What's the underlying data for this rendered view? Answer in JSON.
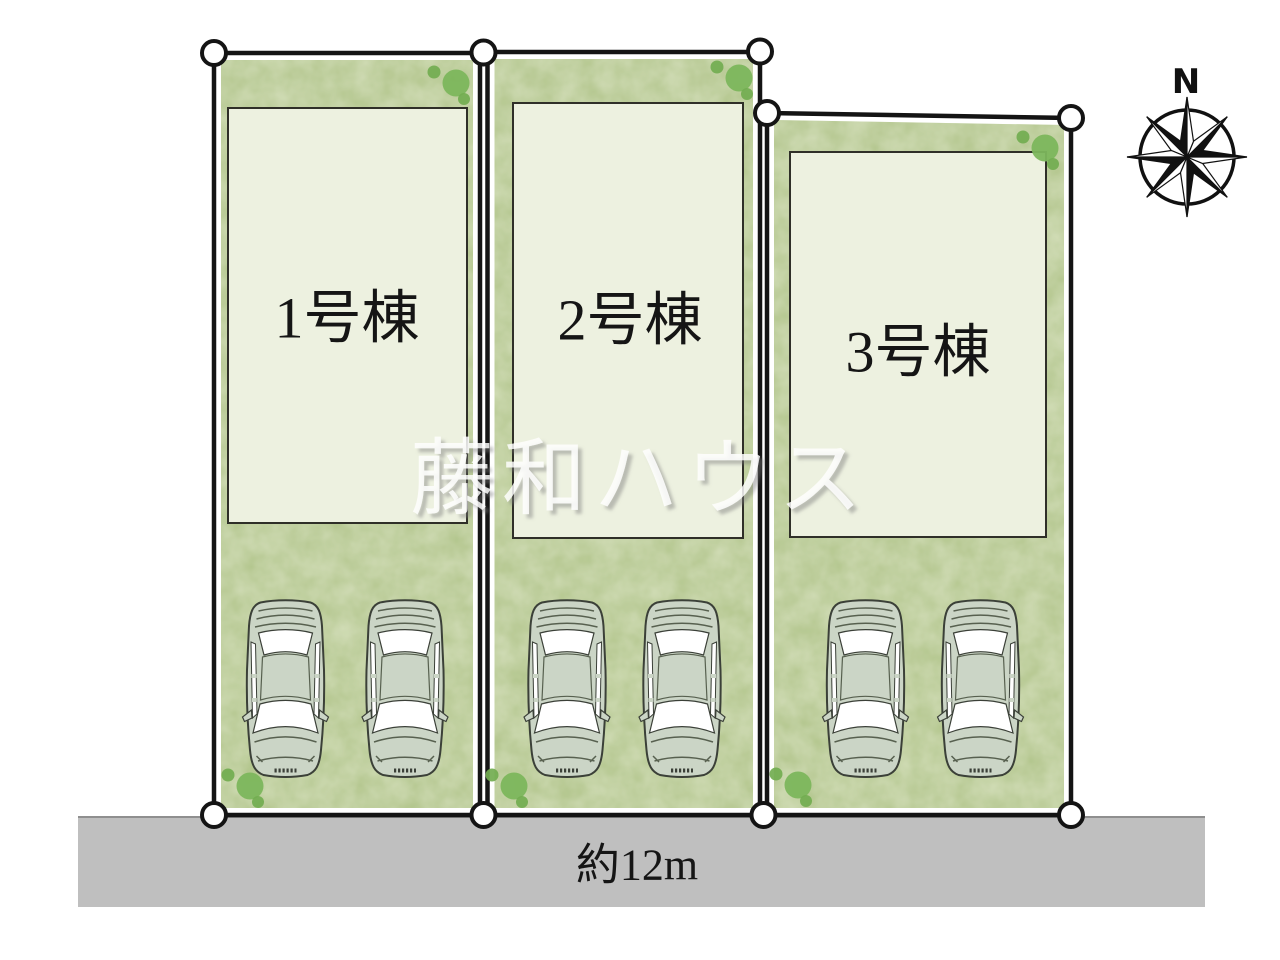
{
  "plan": {
    "watermark": {
      "text": "藤和ハウス"
    },
    "compass": {
      "north_label": "N"
    },
    "road": {
      "width_label": "約12m"
    },
    "lots": [
      {
        "id": 1,
        "label": "1号棟",
        "parking_spaces": 2
      },
      {
        "id": 2,
        "label": "2号棟",
        "parking_spaces": 2
      },
      {
        "id": 3,
        "label": "3号棟",
        "parking_spaces": 2
      }
    ],
    "colors": {
      "grass": "#b0c489",
      "grass_mottle": "#cfdca6",
      "building_fill": "#edf1e0",
      "road_fill": "#bfbfbf",
      "outline": "#141414",
      "tree_green": "#7cb65c",
      "car_body": "#cbd5c6"
    }
  }
}
